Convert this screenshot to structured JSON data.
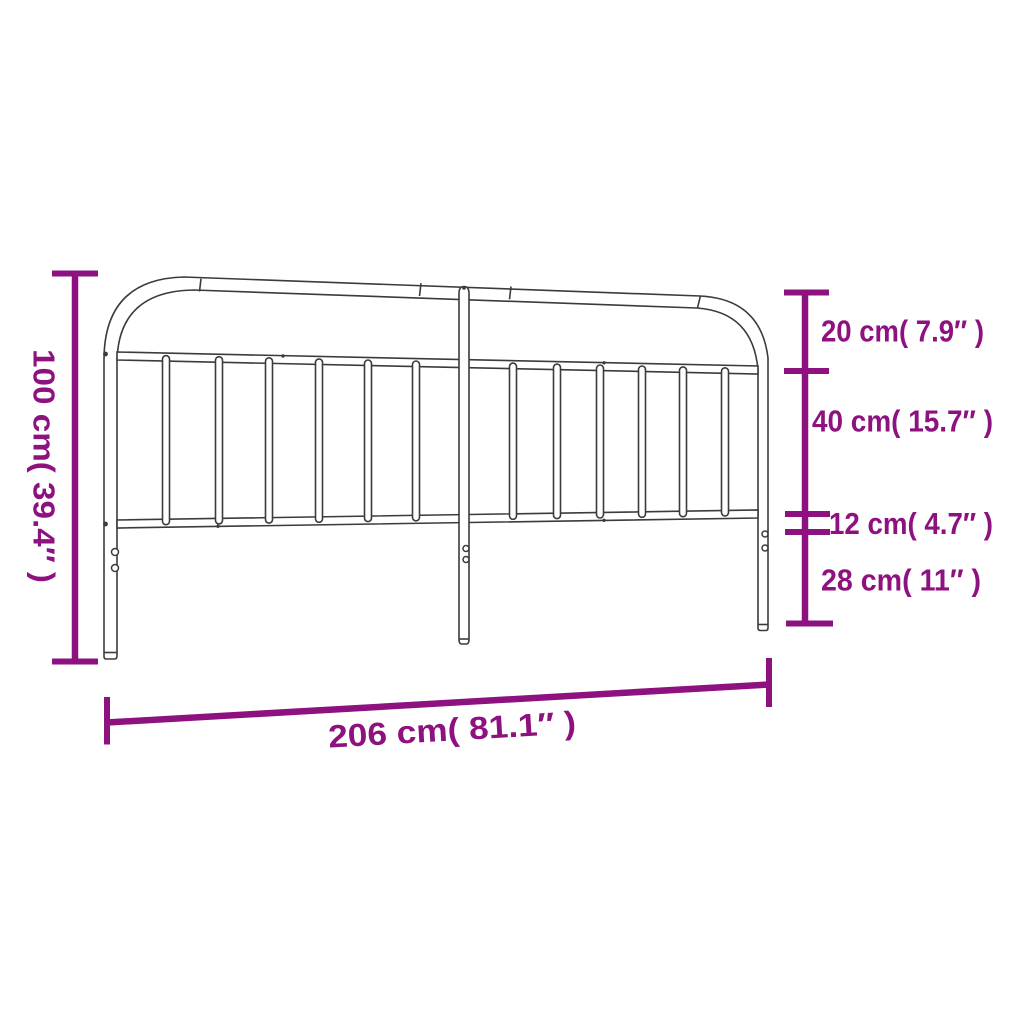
{
  "colors": {
    "background": "#ffffff",
    "accent": "#8E1180",
    "line": "#3B3B3A"
  },
  "figure": {
    "subject": "metal headboard line drawing",
    "spindle_count": 12,
    "leg_count": 3,
    "holes_per_leg": 2
  },
  "dimensions": {
    "height": {
      "cm": "100",
      "inch": "39.4",
      "label": "100 cm( 39.4″ )"
    },
    "top_gap": {
      "cm": "20",
      "inch": "7.9",
      "label": "20 cm( 7.9″ )"
    },
    "grill": {
      "cm": "40",
      "inch": "15.7",
      "label": "40 cm( 15.7″ )"
    },
    "rail_offset": {
      "cm": "12",
      "inch": "4.7",
      "label": "12 cm( 4.7″ )"
    },
    "leg": {
      "cm": "28",
      "inch": "11",
      "label": "28 cm( 11″ )"
    },
    "width": {
      "cm": "206",
      "inch": "81.1",
      "label": "206 cm( 81.1″ )"
    }
  }
}
